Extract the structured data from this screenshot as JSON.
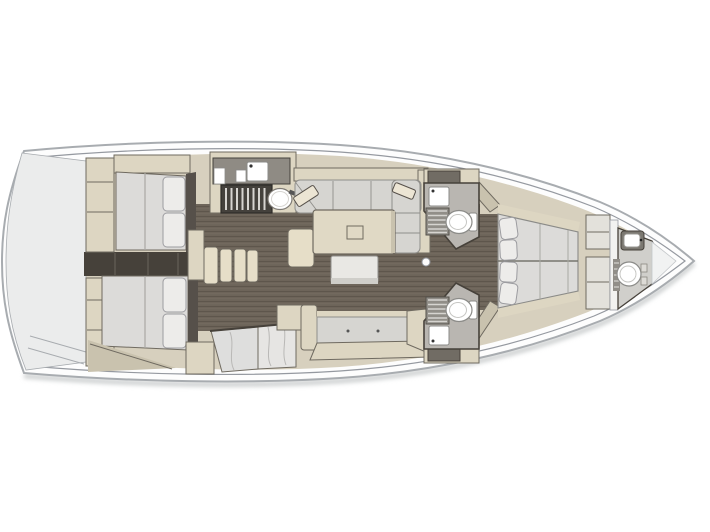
{
  "meta": {
    "description": "Top-down interior layout plan of a sailing yacht (floor plan rendering, no visible text)",
    "orientation": "bow-right-stern-left"
  },
  "palette": {
    "page_bg": "#ffffff",
    "hull_line": "#a8acb0",
    "hull_inner": "#9599a0",
    "hull_fill": "#fdfdfd",
    "shadow_soft": "#cfd1d2",
    "stern_fill": "#ebecec",
    "interior_base": "#d7d0be",
    "furniture_beige": "#ddd6c2",
    "furniture_beige_deep": "#c9c2ae",
    "step_beige": "#e6dec8",
    "table_beige": "#e0d9c5",
    "floor_brown": "#6d6459",
    "wall_dark": "#46413a",
    "headboard_dark": "#56504a",
    "mattress": "#dcdbd9",
    "mattress_seam": "#a9a8a4",
    "pillow": "#edecea",
    "pillow_edge": "#9c9ca0",
    "cushion": "#d6d5d1",
    "cushion_edge": "#8f8e8a",
    "counter_dark": "#8f8b84",
    "stove_dark": "#44413c",
    "grate_body": "#918e88",
    "grate_bar": "#d6d4d0",
    "head_floor": "#b9b6b1",
    "bow_head_floor": "#d0cfcb",
    "fixture_white": "#ffffff",
    "fixture_edge": "#8b8b88",
    "marble_a": "#dededd",
    "marble_b": "#e6e5e3",
    "marble_vein": "#b9b8b6",
    "stool_white": "#e9e8e4",
    "panel_light": "#e3e1db",
    "bulkhead_white": "#f2f2f0",
    "tip_white": "#f1f2f2",
    "outline_dark": "#6f6a60",
    "accent_item": "#ece5d4"
  },
  "regions": {
    "hull": "Yacht hull",
    "stern_platform": "Stern swim platform",
    "aft_cabin_starboard": "Aft double cabin (starboard)",
    "aft_cabin_port": "Aft double cabin (port)",
    "companionway": "Companionway steps",
    "galley": "Galley with stove and sinks",
    "salon": "Salon with U-sofa and table",
    "port_settee": "Port settee and sideboard",
    "head_forward_starboard": "Forward head with shower (starboard)",
    "head_forward_port": "Forward head with shower (port)",
    "owner_cabin": "Forward owner cabin with island berth",
    "bow_head": "Bow utility head"
  },
  "fixtures": [
    "double-berth",
    "pillow",
    "wardrobe",
    "companionway-steps",
    "stove-icon",
    "sink-icon",
    "round-sink-icon",
    "salon-table",
    "u-sofa",
    "settee",
    "toilet-icon",
    "shower-grate-icon",
    "island-berth",
    "washbasin-icon",
    "compression-post"
  ]
}
